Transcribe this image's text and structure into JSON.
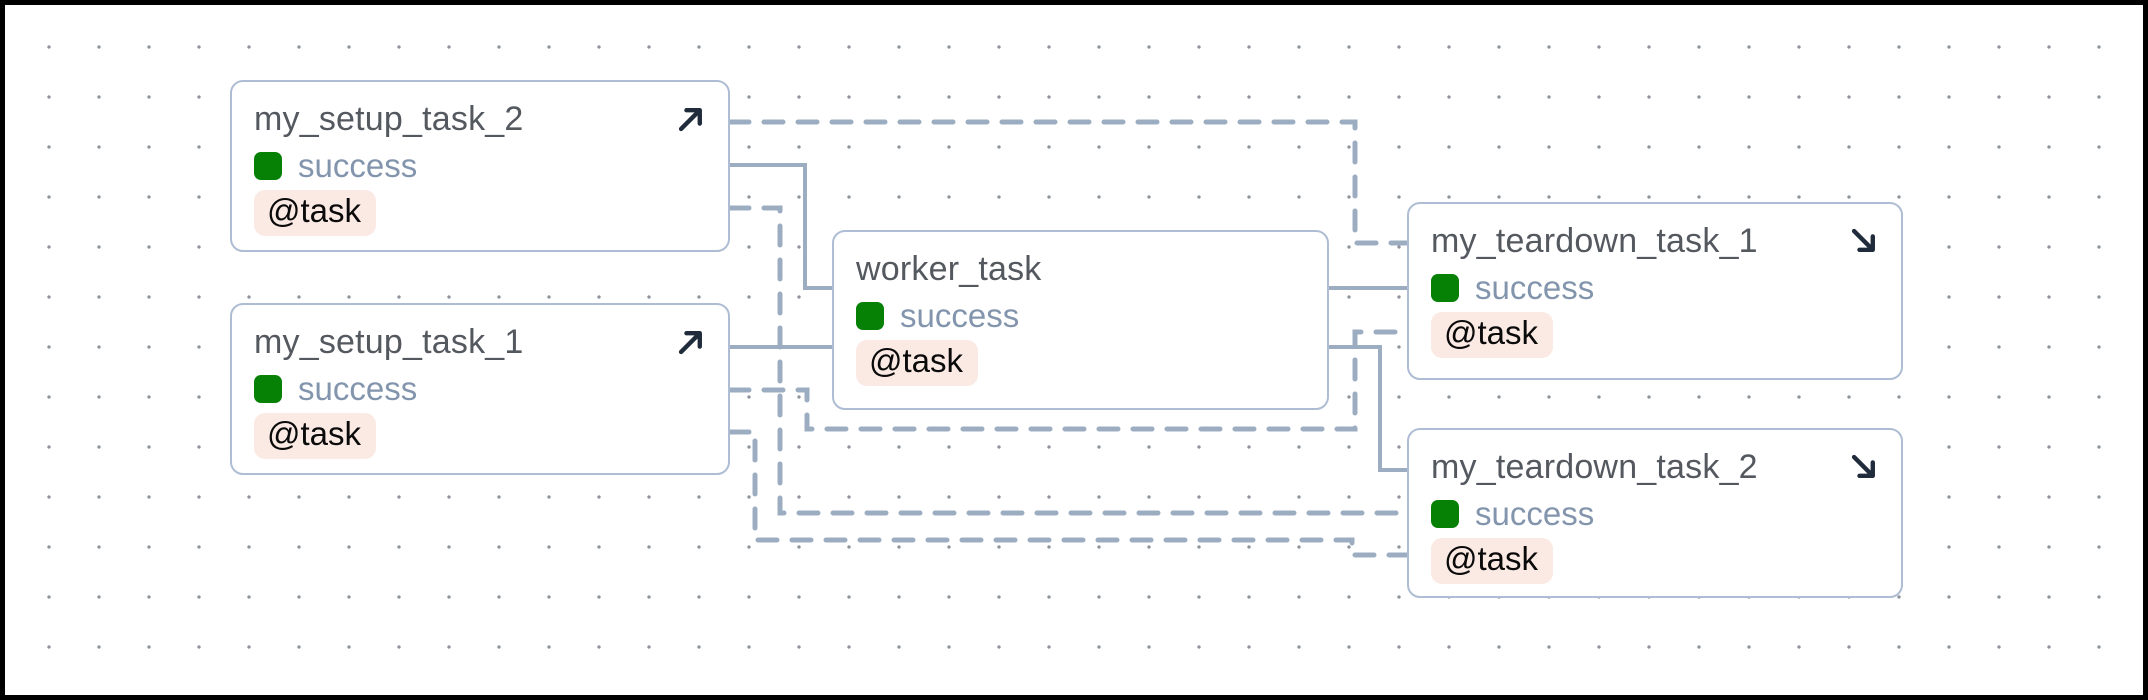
{
  "diagram": {
    "canvas": {
      "width": 2148,
      "height": 700,
      "frame_color": "#000000",
      "background": "#ffffff",
      "dot_color": "#8d929b",
      "dot_grid_size": 50
    },
    "colors": {
      "edge": "#9cadc1",
      "node_border": "#aebdd3",
      "node_background": "#ffffff",
      "title_text": "#54585f",
      "status_text": "#8395ad",
      "success_green": "#068106",
      "badge_background": "#fbe9e4",
      "badge_text": "#0a0a0a",
      "arrow_icon": "#202c3c"
    },
    "nodes": [
      {
        "id": "my_setup_task_2",
        "label": "my_setup_task_2",
        "status": "success",
        "decorator": "@task",
        "kind": "setup",
        "icon": "arrow-up-right",
        "x": 230,
        "y": 80,
        "w": 500,
        "h": 172
      },
      {
        "id": "my_setup_task_1",
        "label": "my_setup_task_1",
        "status": "success",
        "decorator": "@task",
        "kind": "setup",
        "icon": "arrow-up-right",
        "x": 230,
        "y": 303,
        "w": 500,
        "h": 172
      },
      {
        "id": "worker_task",
        "label": "worker_task",
        "status": "success",
        "decorator": "@task",
        "kind": "work",
        "icon": "",
        "x": 832,
        "y": 230,
        "w": 497,
        "h": 180
      },
      {
        "id": "my_teardown_task_1",
        "label": "my_teardown_task_1",
        "status": "success",
        "decorator": "@task",
        "kind": "teardown",
        "icon": "arrow-down-right",
        "x": 1407,
        "y": 202,
        "w": 496,
        "h": 178
      },
      {
        "id": "my_teardown_task_2",
        "label": "my_teardown_task_2",
        "status": "success",
        "decorator": "@task",
        "kind": "teardown",
        "icon": "arrow-down-right",
        "x": 1407,
        "y": 428,
        "w": 496,
        "h": 170
      }
    ],
    "edges": [
      {
        "from": "my_setup_task_2",
        "to": "my_teardown_task_1",
        "style": "dashed",
        "points": [
          [
            730,
            122
          ],
          [
            1355,
            122
          ],
          [
            1355,
            243
          ],
          [
            1407,
            243
          ]
        ]
      },
      {
        "from": "my_setup_task_2",
        "to": "worker_task",
        "style": "solid",
        "points": [
          [
            730,
            165
          ],
          [
            805,
            165
          ],
          [
            805,
            288
          ],
          [
            832,
            288
          ]
        ]
      },
      {
        "from": "my_setup_task_2",
        "to": "my_teardown_task_2",
        "style": "dashed",
        "points": [
          [
            730,
            208
          ],
          [
            780,
            208
          ],
          [
            780,
            513
          ],
          [
            1407,
            513
          ]
        ]
      },
      {
        "from": "my_setup_task_1",
        "to": "worker_task",
        "style": "solid",
        "points": [
          [
            730,
            347
          ],
          [
            832,
            347
          ]
        ]
      },
      {
        "from": "my_setup_task_1",
        "to": "my_teardown_task_1",
        "style": "dashed",
        "points": [
          [
            730,
            390
          ],
          [
            807,
            390
          ],
          [
            807,
            429
          ],
          [
            1355,
            429
          ],
          [
            1355,
            332
          ],
          [
            1407,
            332
          ]
        ]
      },
      {
        "from": "my_setup_task_1",
        "to": "my_teardown_task_2",
        "style": "dashed",
        "points": [
          [
            730,
            432
          ],
          [
            755,
            432
          ],
          [
            755,
            540
          ],
          [
            1352,
            540
          ],
          [
            1352,
            555
          ],
          [
            1407,
            555
          ]
        ]
      },
      {
        "from": "worker_task",
        "to": "my_teardown_task_1",
        "style": "solid",
        "points": [
          [
            1329,
            288
          ],
          [
            1407,
            288
          ]
        ]
      },
      {
        "from": "worker_task",
        "to": "my_teardown_task_2",
        "style": "solid",
        "points": [
          [
            1329,
            347
          ],
          [
            1380,
            347
          ],
          [
            1380,
            470
          ],
          [
            1407,
            470
          ]
        ]
      }
    ]
  }
}
